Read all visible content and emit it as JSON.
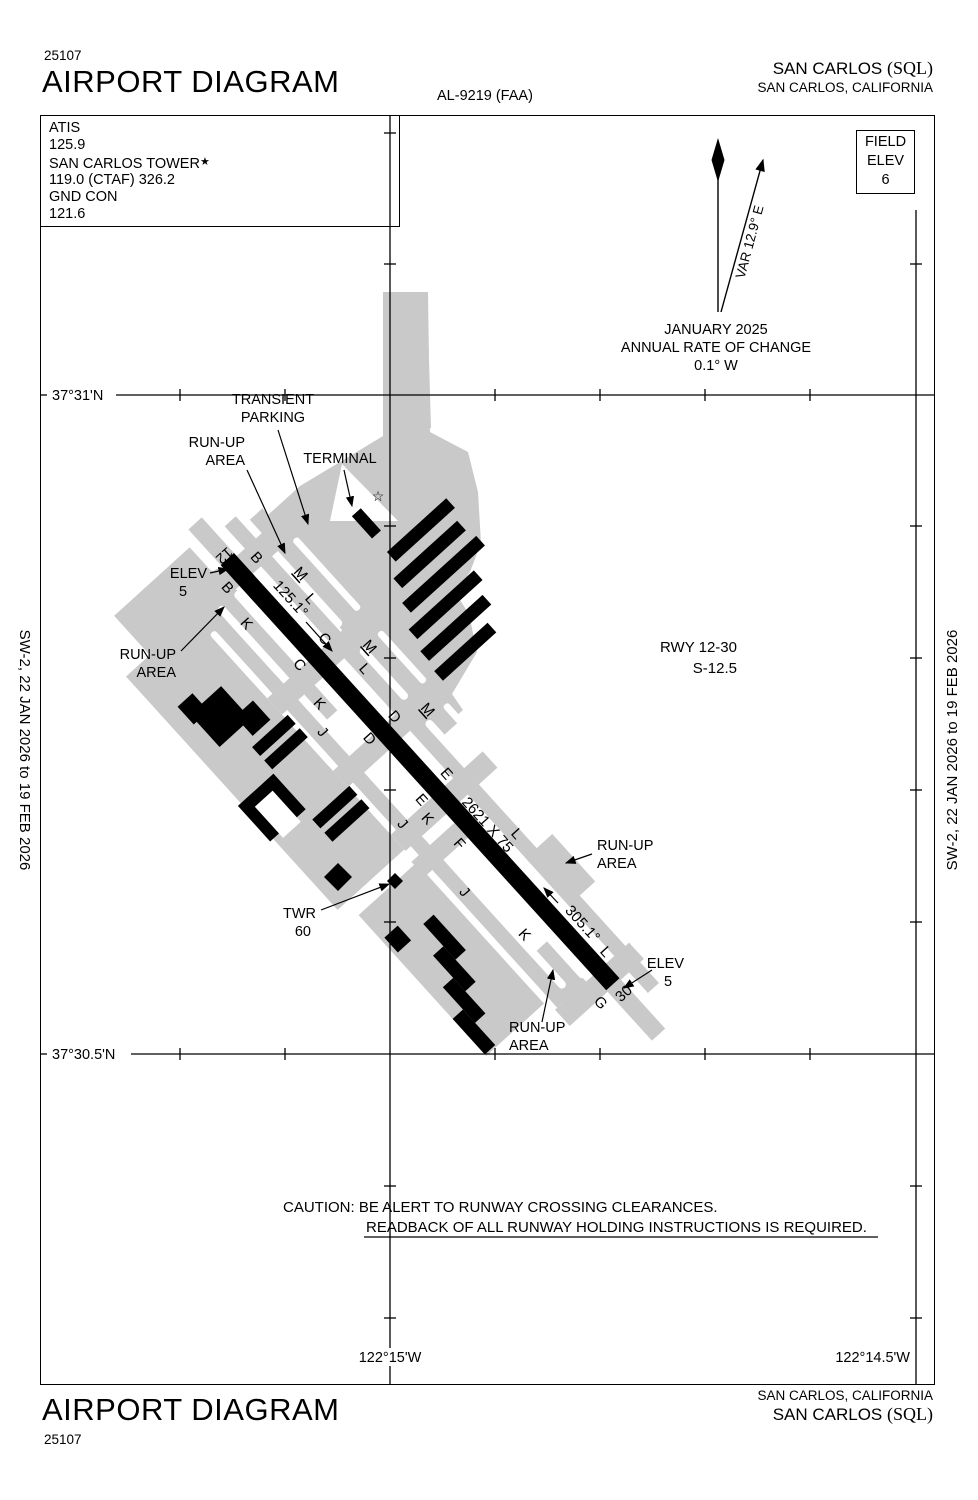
{
  "header": {
    "chart_number": "25107",
    "title": "AIRPORT DIAGRAM",
    "al_number": "AL-9219 (FAA)",
    "airport_pre": "SAN CARLOS ",
    "airport_code": "(SQL)",
    "city_state": "SAN CARLOS, CALIFORNIA"
  },
  "footer": {
    "title": "AIRPORT DIAGRAM",
    "chart_number": "25107",
    "city_state": "SAN CARLOS, CALIFORNIA",
    "airport_pre": "SAN CARLOS ",
    "airport_code": "(SQL)"
  },
  "comm": {
    "l1": "ATIS",
    "l2": "125.9",
    "tower": "SAN CARLOS TOWER",
    "tower_star": "★",
    "l4": "119.0 (CTAF)  326.2",
    "l5": "GND CON",
    "l6": "121.6"
  },
  "field_elev": {
    "l1": "FIELD",
    "l2": "ELEV",
    "l3": "6"
  },
  "compass": {
    "var_label": "VAR 12.9° E",
    "date": "JANUARY 2025",
    "rate": "ANNUAL RATE OF CHANGE",
    "value": "0.1° W"
  },
  "coords": {
    "lat_top": "37°31'N",
    "lat_bottom": "37°30.5'N",
    "lon_left": "122°15'W",
    "lon_right": "122°14.5'W"
  },
  "sidebar": {
    "text": "SW-2,  22 JAN 2026  to  19 FEB 2026"
  },
  "runway_info": {
    "rwy": "RWY 12-30",
    "s": "S-12.5"
  },
  "caution": {
    "line1": "CAUTION: BE ALERT TO RUNWAY CROSSING CLEARANCES.",
    "line2": "READBACK OF ALL RUNWAY HOLDING INSTRUCTIONS IS REQUIRED."
  },
  "colors": {
    "apron_gray": "#c9c9c9",
    "ink": "#000000"
  },
  "diagram": {
    "labels": [
      {
        "t": "TRANSIENT",
        "x": 273,
        "y": 404
      },
      {
        "t": "PARKING",
        "x": 273,
        "y": 422
      },
      {
        "t": "RUN-UP",
        "x": 245,
        "y": 447,
        "a": "end"
      },
      {
        "t": "AREA",
        "x": 245,
        "y": 465,
        "a": "end"
      },
      {
        "t": "T​ERMINAL",
        "x": 340,
        "y": 463
      },
      {
        "t": "ELEV",
        "x": 207,
        "y": 578,
        "a": "end"
      },
      {
        "t": "5",
        "x": 183,
        "y": 596
      },
      {
        "t": "RUN-UP",
        "x": 176,
        "y": 659,
        "a": "end"
      },
      {
        "t": "AREA",
        "x": 176,
        "y": 677,
        "a": "end"
      },
      {
        "t": "RUN-UP",
        "x": 597,
        "y": 850,
        "a": "start"
      },
      {
        "t": "AREA",
        "x": 597,
        "y": 868,
        "a": "start"
      },
      {
        "t": "TWR",
        "x": 316,
        "y": 918,
        "a": "end"
      },
      {
        "t": "60",
        "x": 311,
        "y": 936,
        "a": "end"
      },
      {
        "t": "ELEV",
        "x": 684,
        "y": 968,
        "a": "end"
      },
      {
        "t": "5",
        "x": 668,
        "y": 986
      },
      {
        "t": "RUN-UP",
        "x": 509,
        "y": 1032,
        "a": "start"
      },
      {
        "t": "AREA",
        "x": 509,
        "y": 1050,
        "a": "start"
      },
      {
        "t": "☆",
        "x": 378,
        "y": 501,
        "fs": 14
      },
      {
        "t": "12",
        "x": 221,
        "y": 552,
        "r": 138,
        "fs": 15
      },
      {
        "t": "30",
        "x": 627,
        "y": 997,
        "r": -42,
        "fs": 15
      },
      {
        "t": "B",
        "x": 253,
        "y": 561,
        "r": 48,
        "fs": 15
      },
      {
        "t": "B",
        "x": 224,
        "y": 591,
        "r": 48,
        "fs": 15
      },
      {
        "t": "125.1°",
        "x": 287,
        "y": 602,
        "r": 48,
        "fs": 15
      },
      {
        "t": "305.1°",
        "x": 579,
        "y": 927,
        "r": 48,
        "fs": 15
      },
      {
        "t": "2621 X 75",
        "x": 484,
        "y": 828,
        "r": 48,
        "fs": 15
      },
      {
        "t": "M",
        "x": 297,
        "y": 577,
        "r": 48,
        "fs": 15,
        "u": 1
      },
      {
        "t": "M",
        "x": 366,
        "y": 650,
        "r": 48,
        "fs": 15,
        "u": 1
      },
      {
        "t": "M",
        "x": 424,
        "y": 713,
        "r": 48,
        "fs": 15,
        "u": 1
      },
      {
        "t": "L",
        "x": 307,
        "y": 602,
        "r": 48,
        "fs": 15
      },
      {
        "t": "L",
        "x": 361,
        "y": 672,
        "r": 48,
        "fs": 15
      },
      {
        "t": "L",
        "x": 513,
        "y": 837,
        "r": 48,
        "fs": 15
      },
      {
        "t": "L",
        "x": 602,
        "y": 955,
        "r": 48,
        "fs": 15
      },
      {
        "t": "C",
        "x": 321,
        "y": 642,
        "r": 48,
        "fs": 15
      },
      {
        "t": "C",
        "x": 296,
        "y": 668,
        "r": 48,
        "fs": 15
      },
      {
        "t": "K",
        "x": 243,
        "y": 627,
        "r": 48,
        "fs": 15
      },
      {
        "t": "K",
        "x": 316,
        "y": 707,
        "r": 48,
        "fs": 15
      },
      {
        "t": "K",
        "x": 424,
        "y": 822,
        "r": 48,
        "fs": 15
      },
      {
        "t": "K",
        "x": 521,
        "y": 938,
        "r": 48,
        "fs": 15
      },
      {
        "t": "J",
        "x": 319,
        "y": 735,
        "r": 48,
        "fs": 15
      },
      {
        "t": "J",
        "x": 399,
        "y": 827,
        "r": 48,
        "fs": 15
      },
      {
        "t": "J",
        "x": 461,
        "y": 895,
        "r": 48,
        "fs": 15
      },
      {
        "t": "D",
        "x": 391,
        "y": 720,
        "r": 48,
        "fs": 15
      },
      {
        "t": "D",
        "x": 366,
        "y": 742,
        "r": 48,
        "fs": 15
      },
      {
        "t": "E",
        "x": 443,
        "y": 777,
        "r": 48,
        "fs": 15
      },
      {
        "t": "E",
        "x": 418,
        "y": 803,
        "r": 48,
        "fs": 15
      },
      {
        "t": "F",
        "x": 456,
        "y": 847,
        "r": 48,
        "fs": 15
      },
      {
        "t": "G",
        "x": 597,
        "y": 1006,
        "r": 48,
        "fs": 15
      }
    ],
    "arrows": [
      {
        "x1": 278,
        "y1": 430,
        "x2": 308,
        "y2": 524
      },
      {
        "x1": 247,
        "y1": 470,
        "x2": 285,
        "y2": 553
      },
      {
        "x1": 344,
        "y1": 470,
        "x2": 352,
        "y2": 506
      },
      {
        "x1": 210,
        "y1": 573,
        "x2": 228,
        "y2": 569
      },
      {
        "x1": 181,
        "y1": 651,
        "x2": 224,
        "y2": 607
      },
      {
        "x1": 592,
        "y1": 854,
        "x2": 566,
        "y2": 863
      },
      {
        "x1": 652,
        "y1": 970,
        "x2": 624,
        "y2": 988
      },
      {
        "x1": 321,
        "y1": 910,
        "x2": 389,
        "y2": 884
      },
      {
        "x1": 542,
        "y1": 1022,
        "x2": 553,
        "y2": 970
      },
      {
        "x1": 306,
        "y1": 622,
        "x2": 332,
        "y2": 651
      },
      {
        "x1": 558,
        "y1": 903,
        "x2": 544,
        "y2": 888
      }
    ],
    "grid": {
      "lat": [
        {
          "y": 395,
          "segs": [
            [
              40,
              47
            ],
            [
              116,
              935
            ]
          ],
          "ticks": [
            180,
            285,
            495,
            600,
            705,
            810
          ]
        },
        {
          "y": 1054,
          "segs": [
            [
              40,
              47
            ],
            [
              131,
              935
            ]
          ],
          "ticks": [
            180,
            285,
            495,
            600,
            705,
            810
          ]
        }
      ],
      "lon": [
        {
          "x": 390,
          "y1": 115,
          "y2": 1385,
          "ticks": [
            133,
            264,
            526,
            658,
            790,
            922,
            1186,
            1318
          ]
        },
        {
          "x": 916,
          "y1": 210,
          "y2": 1385,
          "ticks": [
            264,
            526,
            658,
            790,
            922,
            1186,
            1318
          ]
        }
      ]
    }
  }
}
